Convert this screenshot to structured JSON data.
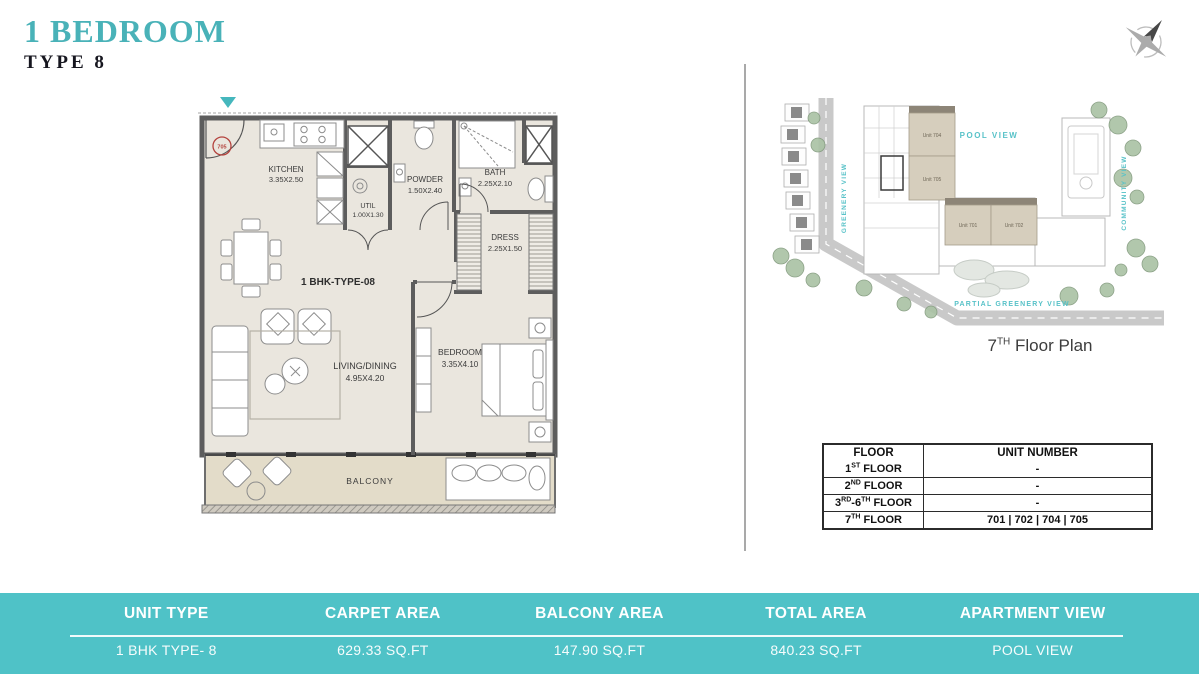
{
  "title": {
    "main": "1 BEDROOM",
    "sub": "TYPE 8"
  },
  "colors": {
    "accent_teal": "#49b2b8",
    "bar_teal": "#4fc2c7",
    "wall_gray": "#5d5d5d",
    "floor_beige": "#eae6de",
    "balcony_tan": "#e3dcc9",
    "unit_highlight": "#d6cebd",
    "view_label_teal": "#58c2c8",
    "entry_red": "#b4433e"
  },
  "floor_plan": {
    "unit_label": "1 BHK-TYPE-08",
    "entry_unit": "705",
    "rooms": {
      "kitchen": {
        "name": "KITCHEN",
        "dims": "3.35X2.50"
      },
      "util": {
        "name": "UTIL",
        "dims": "1.00X1.30"
      },
      "powder": {
        "name": "POWDER",
        "dims": "1.50X2.40"
      },
      "bath": {
        "name": "BATH",
        "dims": "2.25X2.10"
      },
      "dress": {
        "name": "DRESS",
        "dims": "2.25X1.50"
      },
      "living": {
        "name": "LIVING/DINING",
        "dims": "4.95X4.20"
      },
      "bedroom": {
        "name": "BEDROOM",
        "dims": "3.35X4.10"
      },
      "balcony": {
        "name": "BALCONY"
      }
    }
  },
  "site_plan": {
    "caption": [
      {
        "t": "7"
      },
      {
        "t": "TH",
        "sup": true
      },
      {
        "t": " Floor Plan"
      }
    ],
    "views": {
      "left": "GREENERY VIEW",
      "center": "POOL VIEW",
      "right": "COMMUNITY VIEW",
      "bottom": "PARTIAL GREENERY VIEW"
    },
    "units": {
      "u704": "Unit 704",
      "u705": "Unit 705",
      "u701": "Unit 701",
      "u702": "Unit 702"
    }
  },
  "floor_table": {
    "headers": [
      "FLOOR",
      "UNIT NUMBER"
    ],
    "rows": [
      {
        "floor": [
          {
            "t": "1"
          },
          {
            "t": "ST",
            "sup": true
          },
          {
            "t": " FLOOR"
          }
        ],
        "units": "-"
      },
      {
        "floor": [
          {
            "t": "2"
          },
          {
            "t": "ND",
            "sup": true
          },
          {
            "t": " FLOOR"
          }
        ],
        "units": "-"
      },
      {
        "floor": [
          {
            "t": "3"
          },
          {
            "t": "RD",
            "sup": true
          },
          {
            "t": "-6"
          },
          {
            "t": "TH",
            "sup": true
          },
          {
            "t": " FLOOR"
          }
        ],
        "units": "-"
      },
      {
        "floor": [
          {
            "t": "7"
          },
          {
            "t": "TH",
            "sup": true
          },
          {
            "t": " FLOOR"
          }
        ],
        "units": "701 | 702 | 704 | 705"
      }
    ]
  },
  "summary_bar": {
    "columns": [
      {
        "label": "UNIT TYPE",
        "value": "1 BHK TYPE- 8"
      },
      {
        "label": "CARPET AREA",
        "value": "629.33 SQ.FT"
      },
      {
        "label": "BALCONY AREA",
        "value": "147.90 SQ.FT"
      },
      {
        "label": "TOTAL  AREA",
        "value": "840.23 SQ.FT"
      },
      {
        "label": "APARTMENT VIEW",
        "value": "POOL  VIEW"
      }
    ]
  }
}
